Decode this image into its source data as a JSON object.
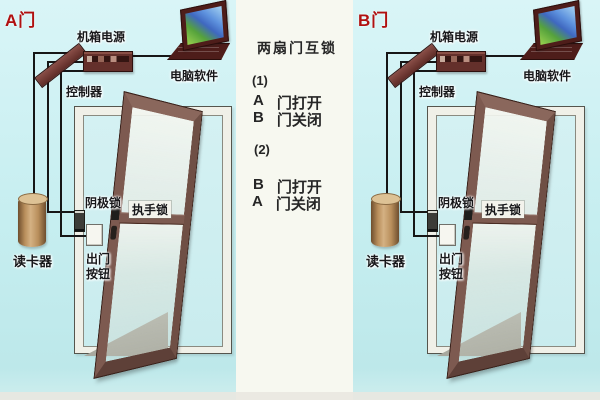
{
  "figure": {
    "kind": "access-control two-door interlock installation diagram",
    "illustrations": [
      "power-box",
      "laptop",
      "controller-wiring",
      "door-frame",
      "open-door",
      "cathode-lock",
      "exit-button",
      "card-reader",
      "floor-shadow"
    ]
  },
  "panels": [
    {
      "id": "A",
      "door_tag": "A门",
      "labels": {
        "power": "机箱电源",
        "software": "电脑软件",
        "controller": "控制器",
        "cathode_lock": "阴极锁",
        "handle_lock": "执手锁",
        "exit_button": [
          "出门",
          "按钮"
        ],
        "card_reader": "读卡器"
      }
    },
    {
      "id": "B",
      "door_tag": "B门",
      "labels": {
        "power": "机箱电源",
        "software": "电脑软件",
        "controller": "控制器",
        "cathode_lock": "阴极锁",
        "handle_lock": "执手锁",
        "exit_button": [
          "出门",
          "按钮"
        ],
        "card_reader": "读卡器"
      }
    }
  ],
  "center_notes": {
    "title": "两扇门互锁",
    "cases": [
      {
        "num": "(1)",
        "lines": [
          {
            "door": "A",
            "state": "门打开"
          },
          {
            "door": "B",
            "state": "门关闭"
          }
        ]
      },
      {
        "num": "(2)",
        "lines": [
          {
            "door": "B",
            "state": "门打开"
          },
          {
            "door": "A",
            "state": "门关闭"
          }
        ]
      }
    ]
  },
  "colors": {
    "background_cyan": "#c6eef0",
    "center_strip": "#f7f8f0",
    "door_tag_red": "#b01010",
    "label_black": "#17171a",
    "door_brown": "#7d5a50",
    "frame_white": "#f0f0e8",
    "wire_black": "#161616",
    "card_reader_tan": "#b98f5c",
    "floor_gray": "#a8a89e",
    "power_box_maroon": "#64302b"
  }
}
